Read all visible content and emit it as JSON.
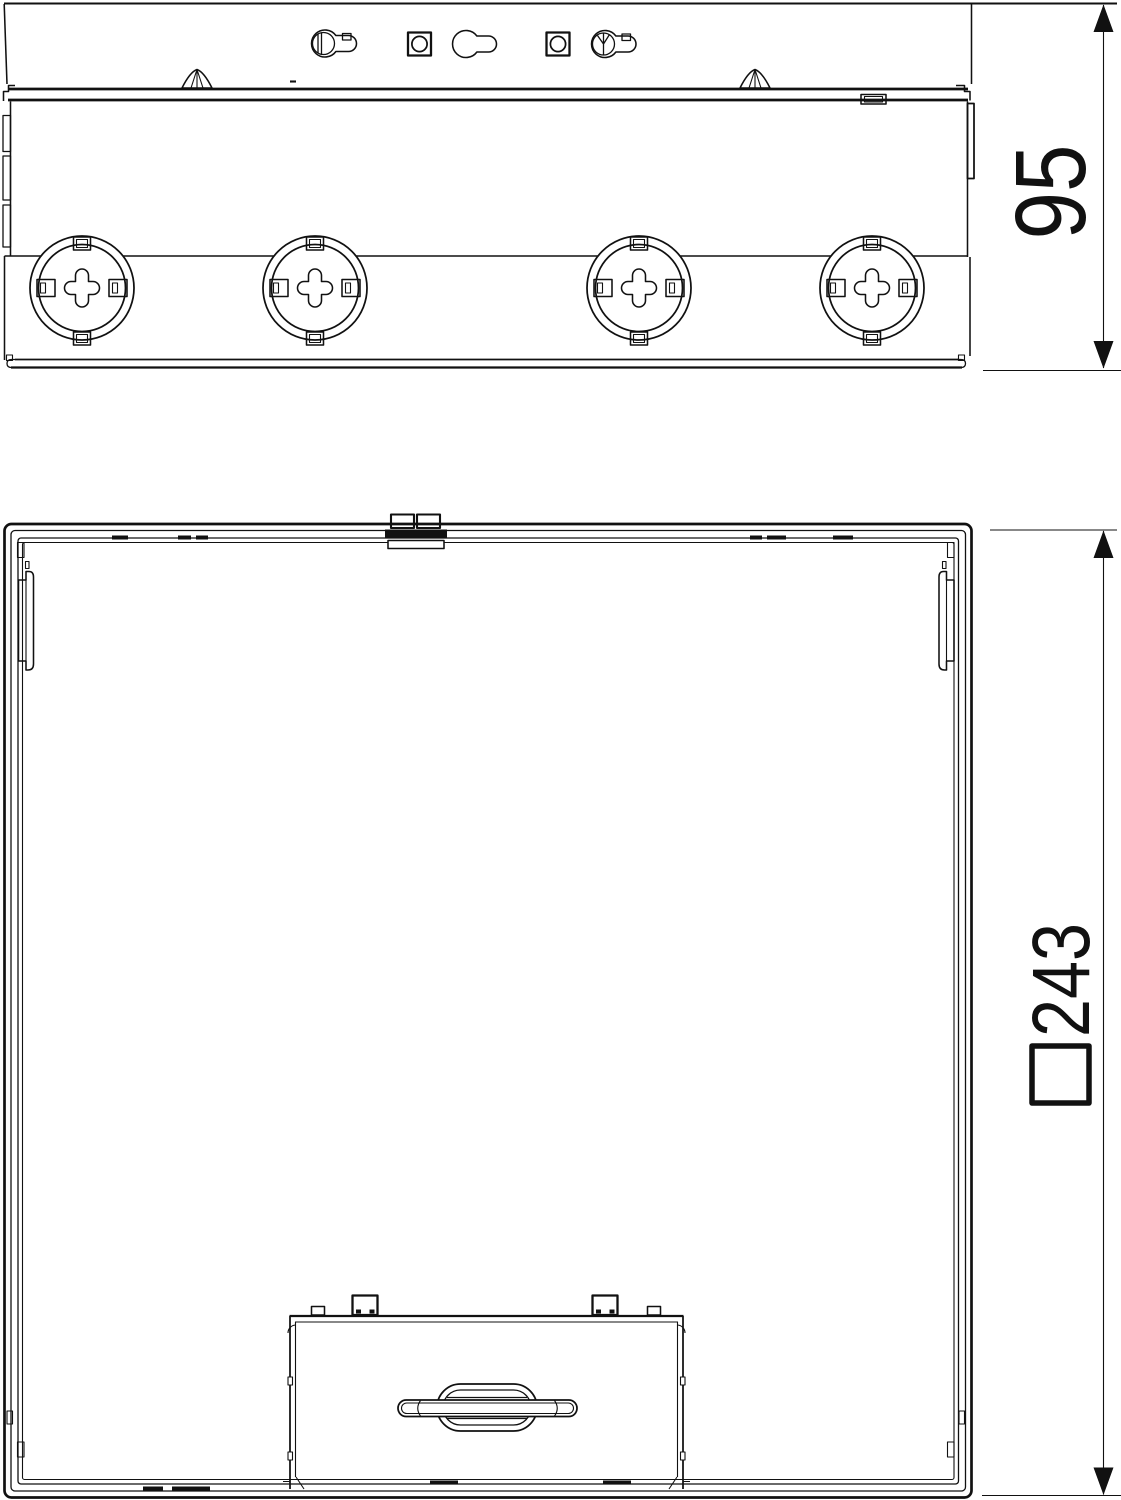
{
  "colors": {
    "background": "#ffffff",
    "line": "#111111"
  },
  "side_view": {
    "height_dimension": "95",
    "knockout_count": 4,
    "keyhole_slot_count": 3,
    "square_hole_count": 2
  },
  "plan_view": {
    "size_dimension": "□243"
  }
}
